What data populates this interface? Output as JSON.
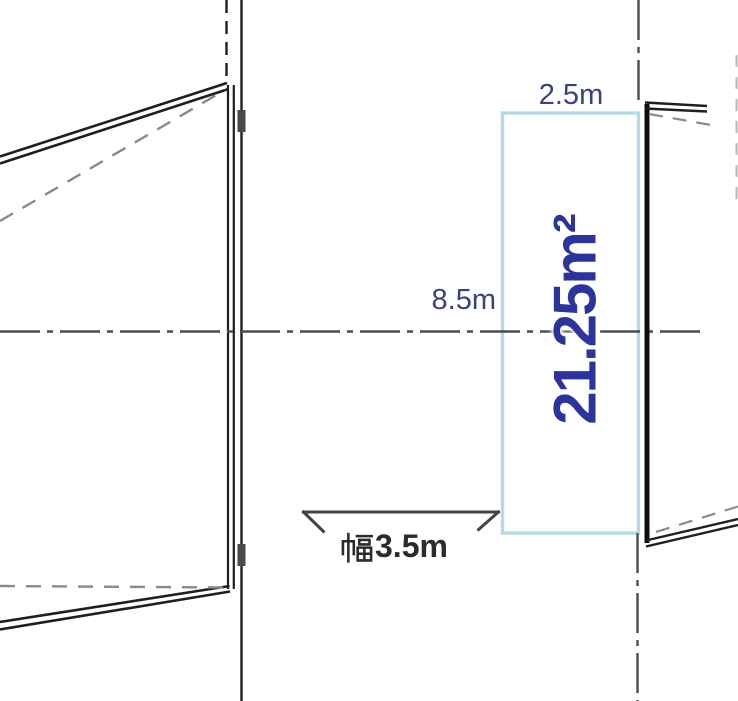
{
  "drawing": {
    "type": "site-plan",
    "labels": {
      "top_width": "2.5m",
      "depth": "8.5m",
      "area": "21.25m²",
      "entrance_width": "幅3.5m",
      "entrance_width_value": "3.5m"
    }
  },
  "colors": {
    "background": "#ffffff",
    "plot_outline": "#b2dbe3",
    "dimension_text": "#3b4283",
    "area_text": "#2c339c",
    "width_text": "#2b2b2b",
    "line_dark": "#1f1f1f",
    "line_gray": "#8a8a8a",
    "centerline": "#4d4d4d",
    "hinge": "#4a4a4a",
    "dim_arrow": "#444444"
  }
}
